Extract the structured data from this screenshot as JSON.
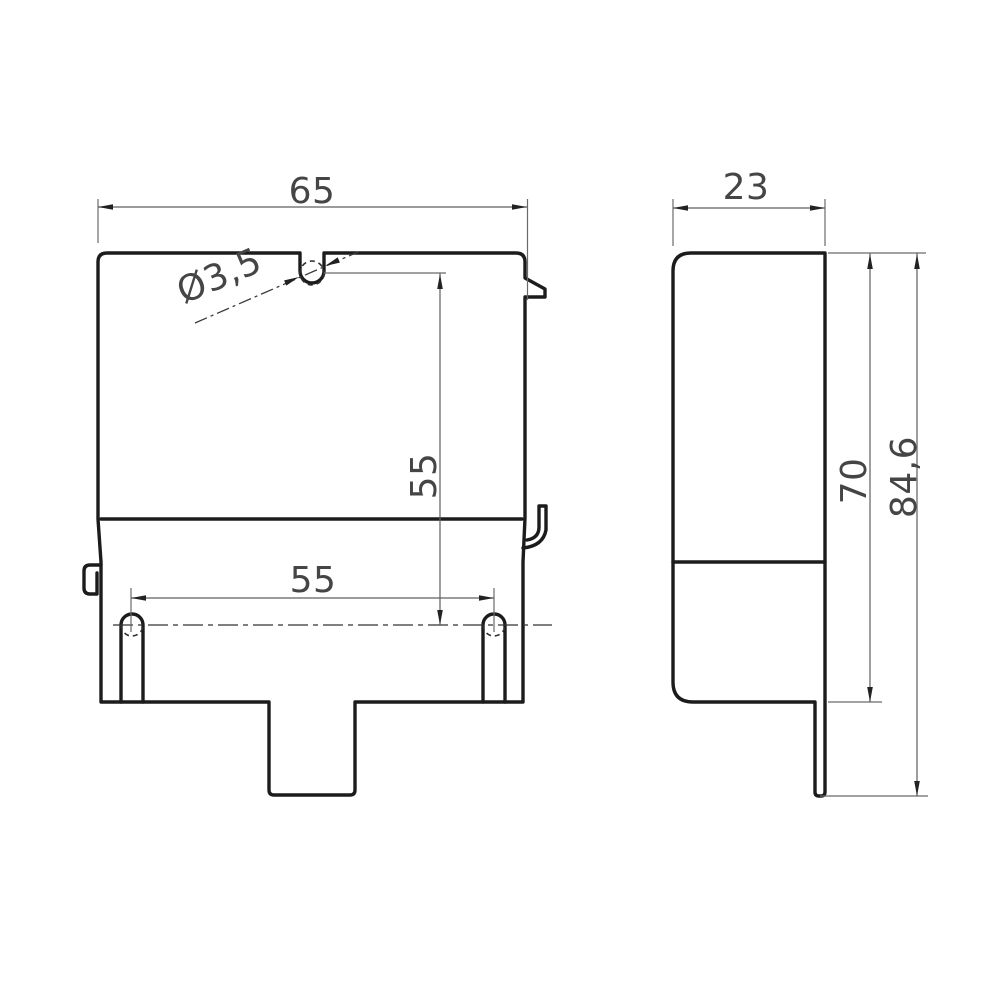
{
  "drawing": {
    "type": "technical-drawing",
    "colors": {
      "background": "#ffffff",
      "outline": "#1c1c1c",
      "dimension_lines": "#5f5f5f",
      "dimension_text": "#454545"
    },
    "views": {
      "front": {
        "dimensions": {
          "overall_width": {
            "label": "65"
          },
          "hole_diameter": {
            "label": "Ø3,5"
          },
          "hole_center_height": {
            "label": "55"
          },
          "hole_spacing": {
            "label": "55"
          }
        }
      },
      "side": {
        "dimensions": {
          "depth": {
            "label": "23"
          },
          "body_height": {
            "label": "70"
          },
          "overall_height": {
            "label": "84,6"
          }
        }
      }
    }
  }
}
